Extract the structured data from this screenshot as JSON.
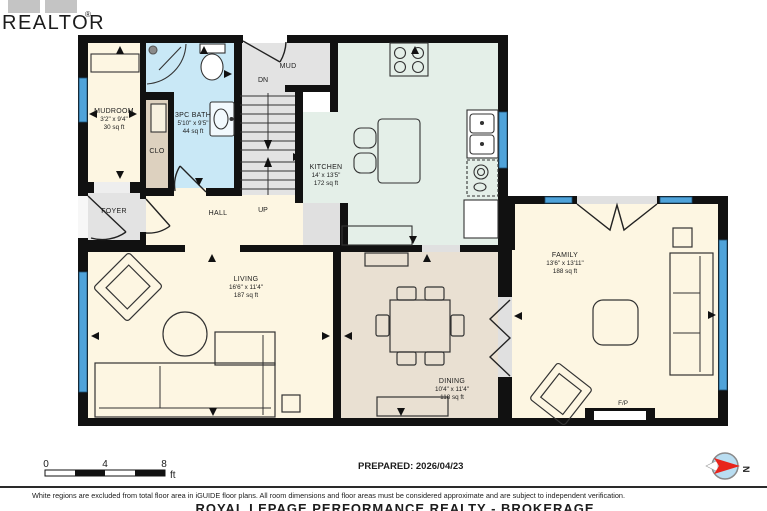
{
  "branding": {
    "wordmark": "REALTOR",
    "registered": "®"
  },
  "plan": {
    "rooms": {
      "mudroom": {
        "name": "MUDROOM",
        "dims": "3'2\" x 9'4\"",
        "area": "30 sq ft"
      },
      "closet": {
        "name": "CLO"
      },
      "bath": {
        "name": "3PC BATH",
        "dims": "5'10\" x 9'5\"",
        "area": "44 sq ft"
      },
      "mud": {
        "name": "MUD"
      },
      "foyer": {
        "name": "FOYER"
      },
      "hall": {
        "name": "HALL"
      },
      "kitchen": {
        "name": "KITCHEN",
        "dims": "14' x 13'5\"",
        "area": "172 sq ft"
      },
      "living": {
        "name": "LIVING",
        "dims": "16'6\" x 11'4\"",
        "area": "187 sq ft"
      },
      "dining": {
        "name": "DINING",
        "dims": "10'4\" x 11'4\"",
        "area": "118 sq ft"
      },
      "family": {
        "name": "FAMILY",
        "dims": "13'6\" x 13'11\"",
        "area": "188 sq ft"
      }
    },
    "stairs": {
      "down": "DN",
      "up": "UP"
    },
    "fireplace_label": "F/P"
  },
  "scale_bar": {
    "ticks": [
      "0",
      "4",
      "8"
    ],
    "unit": "ft"
  },
  "prepared_label": "PREPARED: 2026/04/23",
  "compass": {
    "north": "N"
  },
  "footer": {
    "disclaimer": "White regions are excluded from total floor area in iGUIDE floor plans. All room dimensions and floor areas must be considered approximate and are subject to independent verification.",
    "watermark": "ROYAL LEPAGE PERFORMANCE REALTY - BROKERAGE"
  },
  "colors": {
    "wall": "#111111",
    "cream": "#fdf6e2",
    "bath_blue": "#c9e8f6",
    "kitchen_mint": "#e4efe8",
    "dining_tan": "#e9e0d2",
    "gray": "#e3e3e3",
    "closet_tan": "#ddd1bf",
    "window_blue": "#4fa3da",
    "compass_red": "#e8241c",
    "logo_gray": "#bcbcbc"
  }
}
